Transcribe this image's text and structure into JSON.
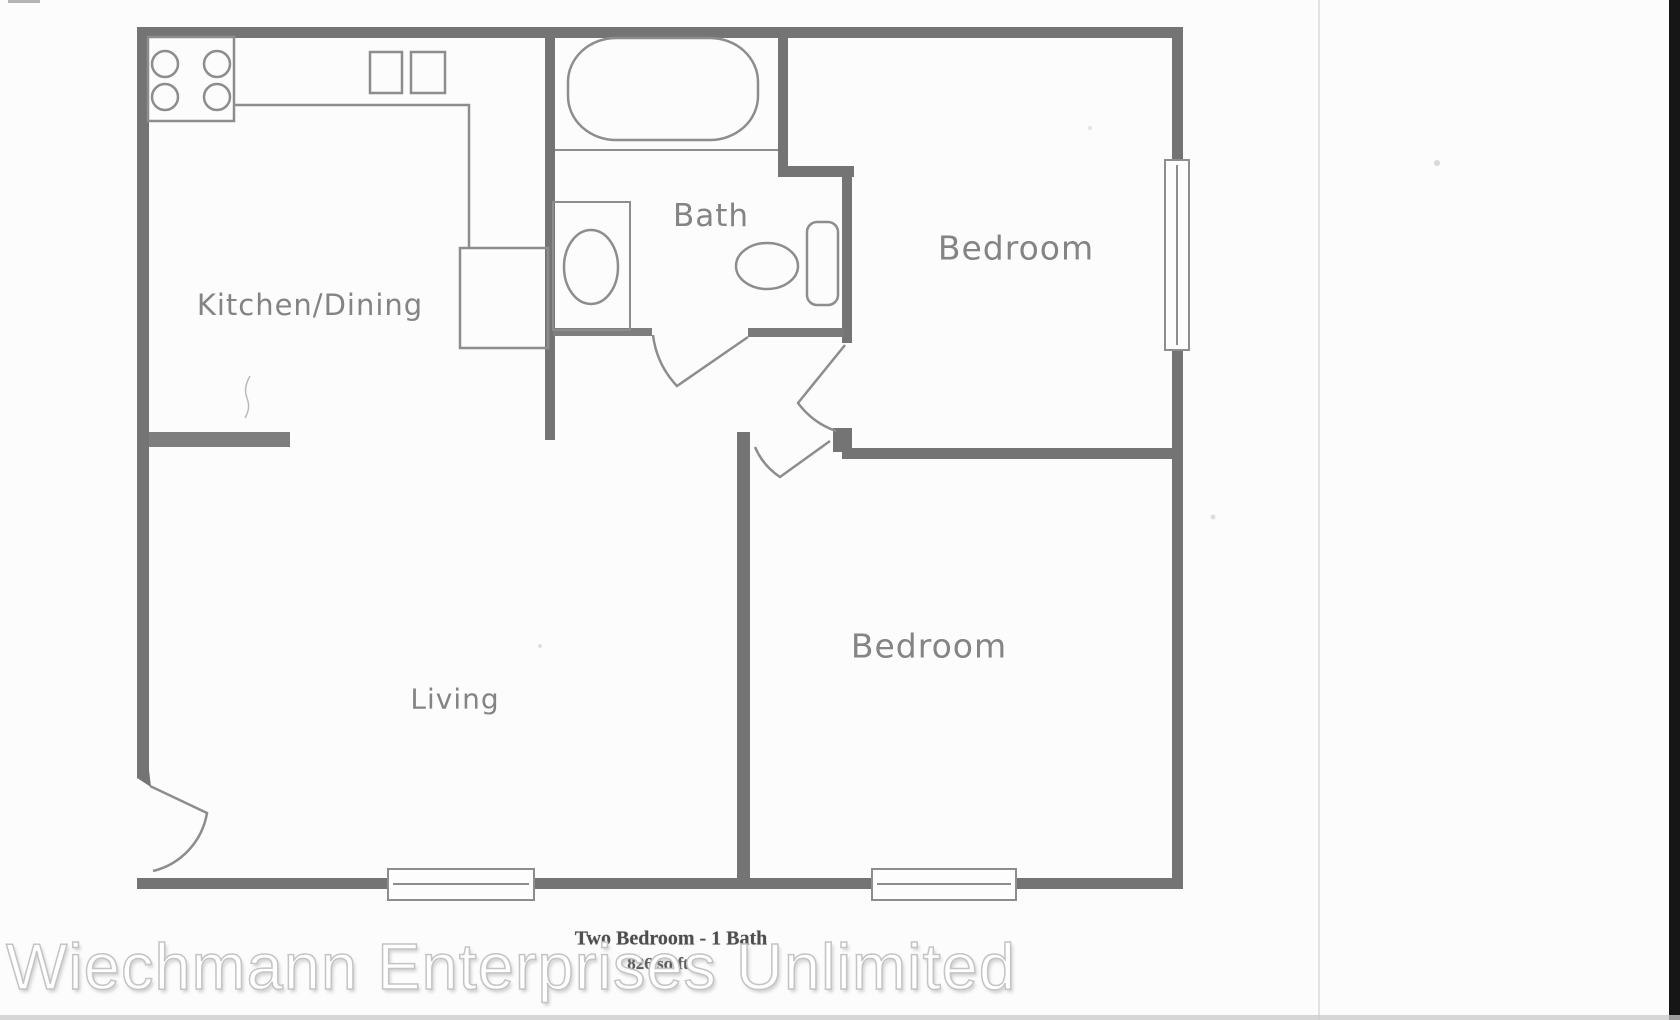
{
  "page": {
    "background_color": "#fcfcfc",
    "divider_line_color": "#e2e2e2",
    "right_edge_bar_color": "#161616",
    "bottom_edge_strip_color": "#c9c9c9"
  },
  "plan": {
    "wall_color": "#747474",
    "fixture_line_color": "#8d8d8d",
    "label_color": "#848484",
    "rooms": {
      "kitchen": "Kitchen/Dining",
      "bath": "Bath",
      "bedroom_upper": "Bedroom",
      "living": "Living",
      "bedroom_lower": "Bedroom"
    },
    "caption": {
      "line1": "Two Bedroom - 1 Bath",
      "line2": "826 sq ft",
      "color": "#4e4e4e"
    }
  },
  "watermark": {
    "text": "Wiechmann Enterprises Unlimited",
    "fill_color": "#ffffff",
    "outline_color": "#c4c4c4"
  }
}
